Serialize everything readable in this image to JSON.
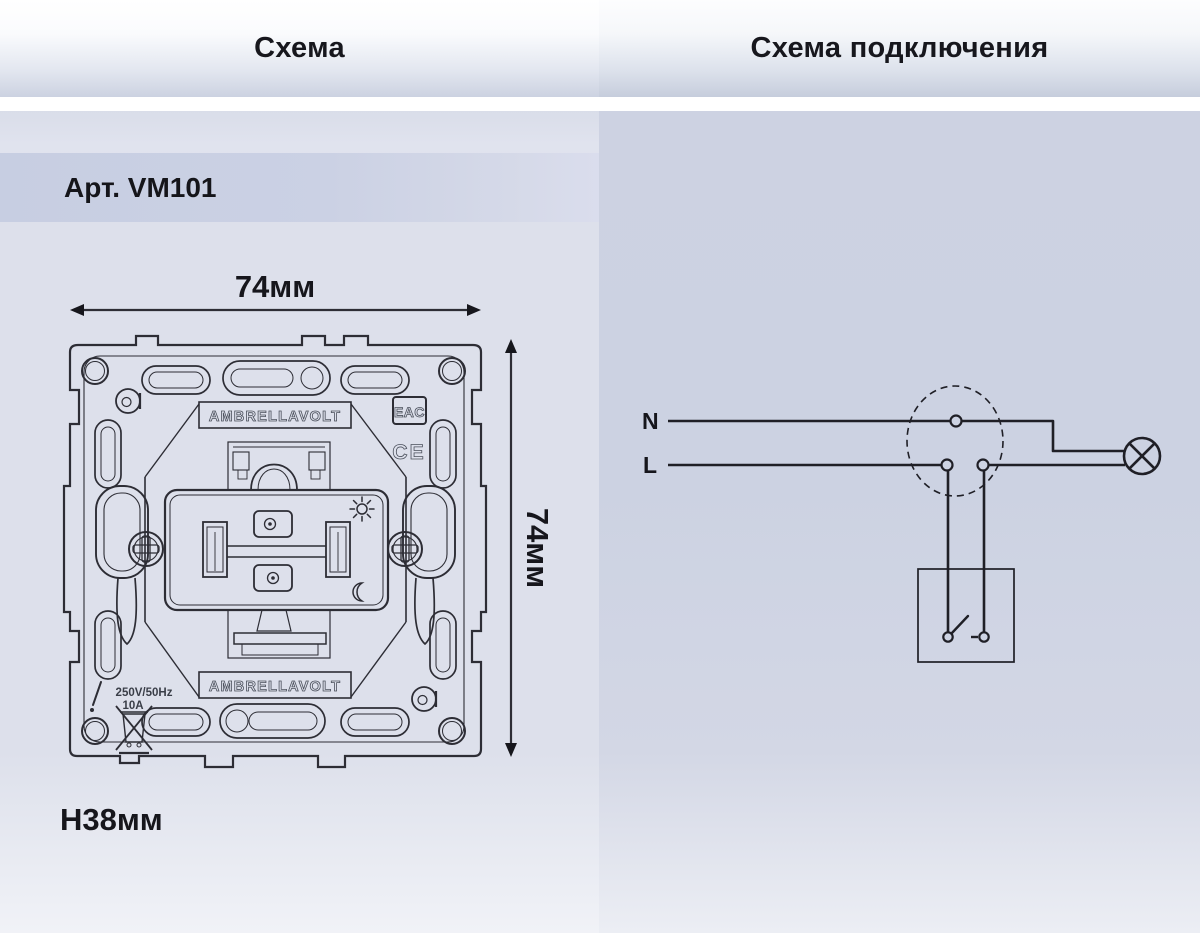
{
  "headers": {
    "left_title": "Схема",
    "right_title": "Схема подключения"
  },
  "product": {
    "article_label": "Арт. VM101"
  },
  "dimensions": {
    "width": "74мм",
    "height": "74мм",
    "depth": "Н38мм"
  },
  "mechanism": {
    "brand_top": "AMBRELLAVOLT",
    "brand_bottom": "AMBRELLAVOLT",
    "eac_mark": "EAC",
    "ce_mark": "CE",
    "voltage_rating": "250V/50Hz",
    "current_rating": "10A"
  },
  "wiring": {
    "neutral_label": "N",
    "line_label": "L"
  },
  "colors": {
    "line_art": "#2d2d35",
    "wire": "#1f1f26",
    "text": "#16161c",
    "panel_left_bg": "#dde0eb",
    "panel_right_bg": "#cdd2e2",
    "article_strip_bg": "#c9cfe2",
    "header_gradient_bottom": "#c9d0df"
  }
}
